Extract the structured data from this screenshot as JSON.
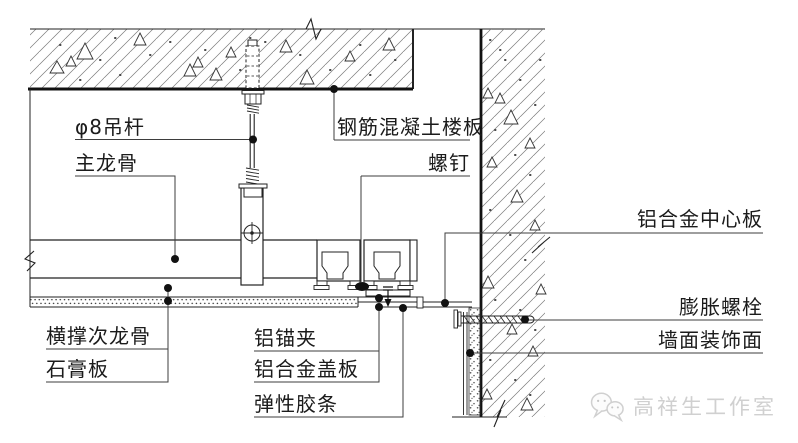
{
  "drawing": {
    "type": "ceiling-construction-detail-section",
    "labels": {
      "hanger_rod": "φ8吊杆",
      "main_keel": "主龙骨",
      "concrete_slab": "钢筋混凝土楼板",
      "screw": "螺钉",
      "aluminum_center_panel": "铝合金中心板",
      "expansion_bolt": "膨胀螺栓",
      "wall_decorative_finish": "墙面装饰面",
      "cross_brace_secondary_keel": "横撑次龙骨",
      "gypsum_board": "石膏板",
      "aluminum_anchor_clip": "铝锚夹",
      "aluminum_cover_plate": "铝合金盖板",
      "elastic_rubber_strip": "弹性胶条"
    },
    "watermark": {
      "studio_name": "高祥生工作室",
      "logo": "wechat-bubbles-icon"
    },
    "colors": {
      "line": "#222222",
      "hatch": "#7a7a7a",
      "leader": "#3d3d3d",
      "watermark": "#d0d0d0",
      "background": "#ffffff"
    }
  }
}
